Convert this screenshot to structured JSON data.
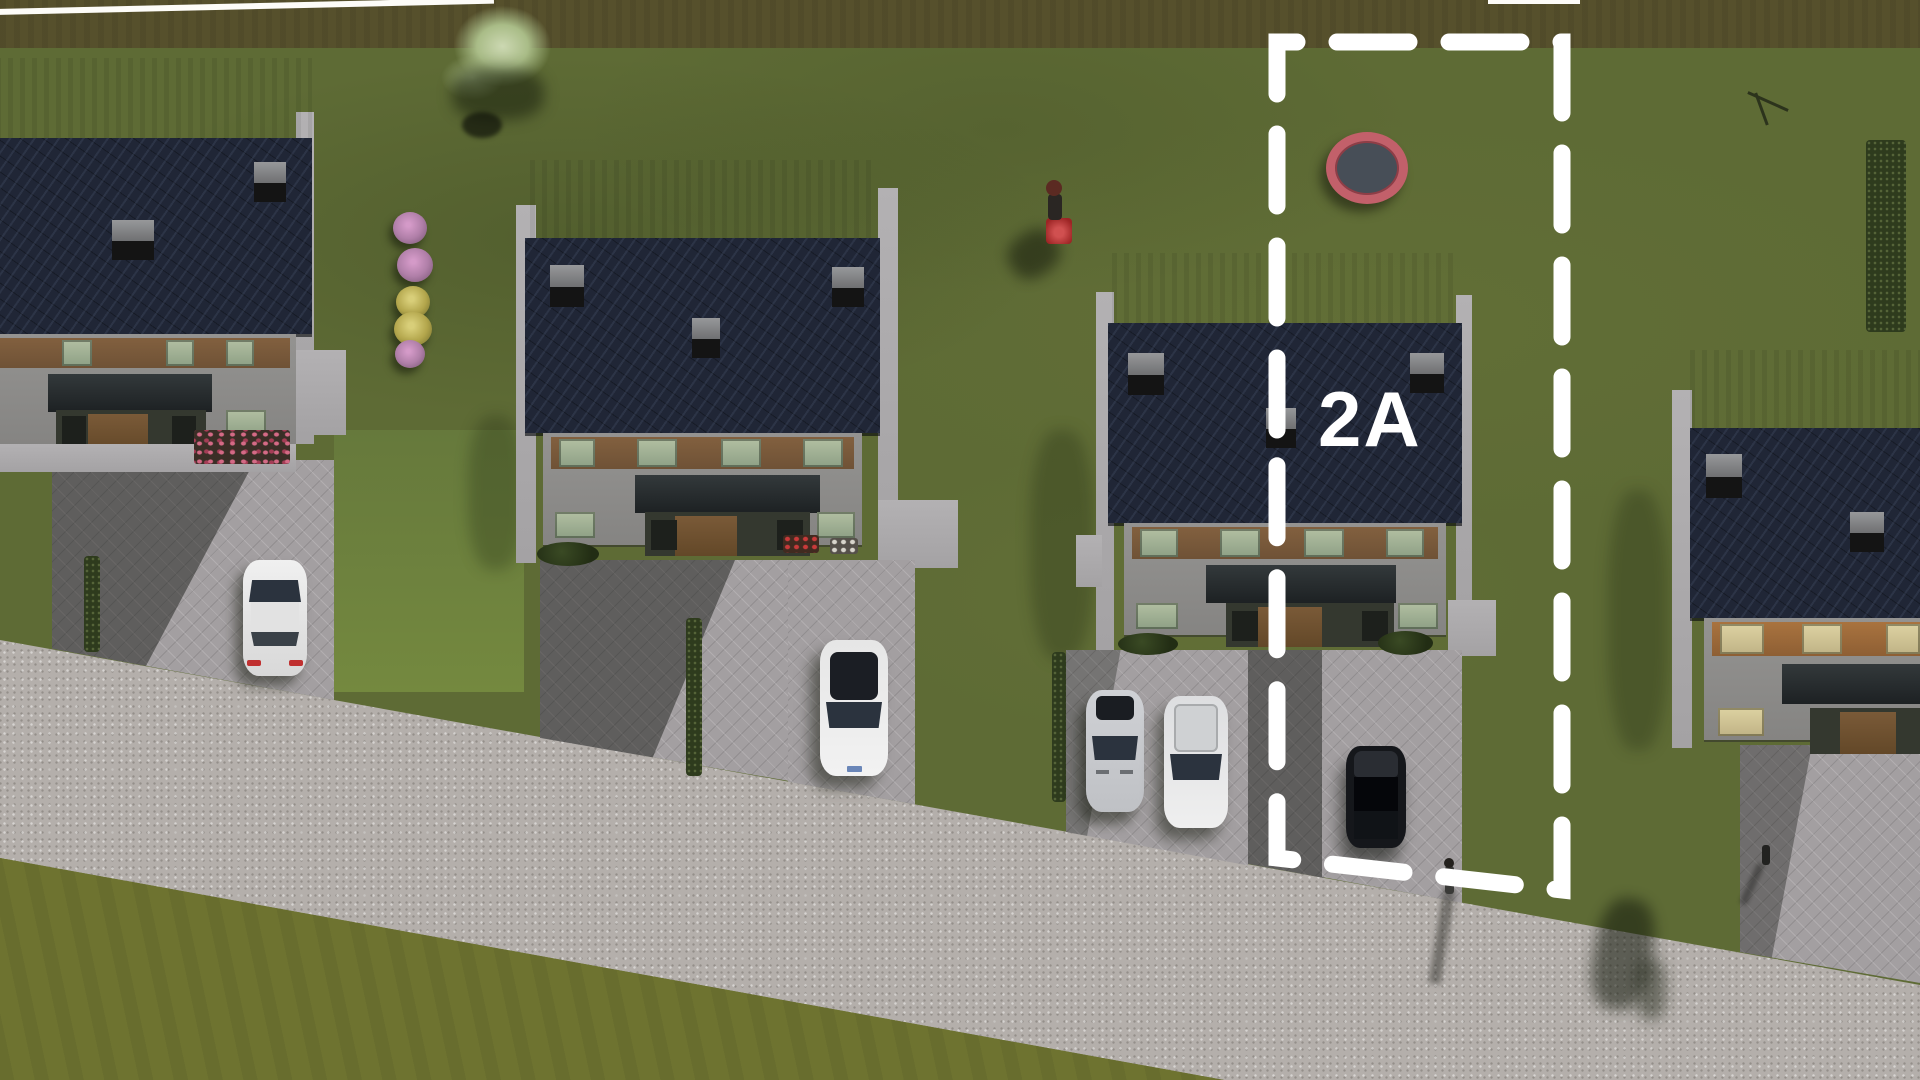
{
  "plot": {
    "label": "2A",
    "boundary_color": "#ffffff",
    "label_color": "#ffffff"
  },
  "scene": {
    "type": "aerial-3d-site-render",
    "houses_visible": 4,
    "cars_visible": 5,
    "pedestrians_visible": 2,
    "objects": [
      "trampoline",
      "lawnmower-person",
      "ornamental-grass",
      "flower-bushes",
      "hedges",
      "road"
    ]
  },
  "colors": {
    "lawn": "#5e6b35",
    "lawn_top_band": "#56502c",
    "lawn_below_road": "#6e7330",
    "road": "#b4afab",
    "driveway": "#a39fa1",
    "roof_main": "#202636",
    "roof_back": "#3e4130",
    "facade": "#8d8c8a",
    "wood_panel": "#7b5c3d",
    "awning": "#202426",
    "window_glass": "#a3b296",
    "trampoline_ring": "#c2606a",
    "trampoline_mat": "#474e57",
    "car_white": "#e9e9e9",
    "car_silver": "#c9cbcf",
    "car_black": "#15171b",
    "flower_pink": "#b07fa8",
    "flower_yellow": "#b3a64c"
  }
}
